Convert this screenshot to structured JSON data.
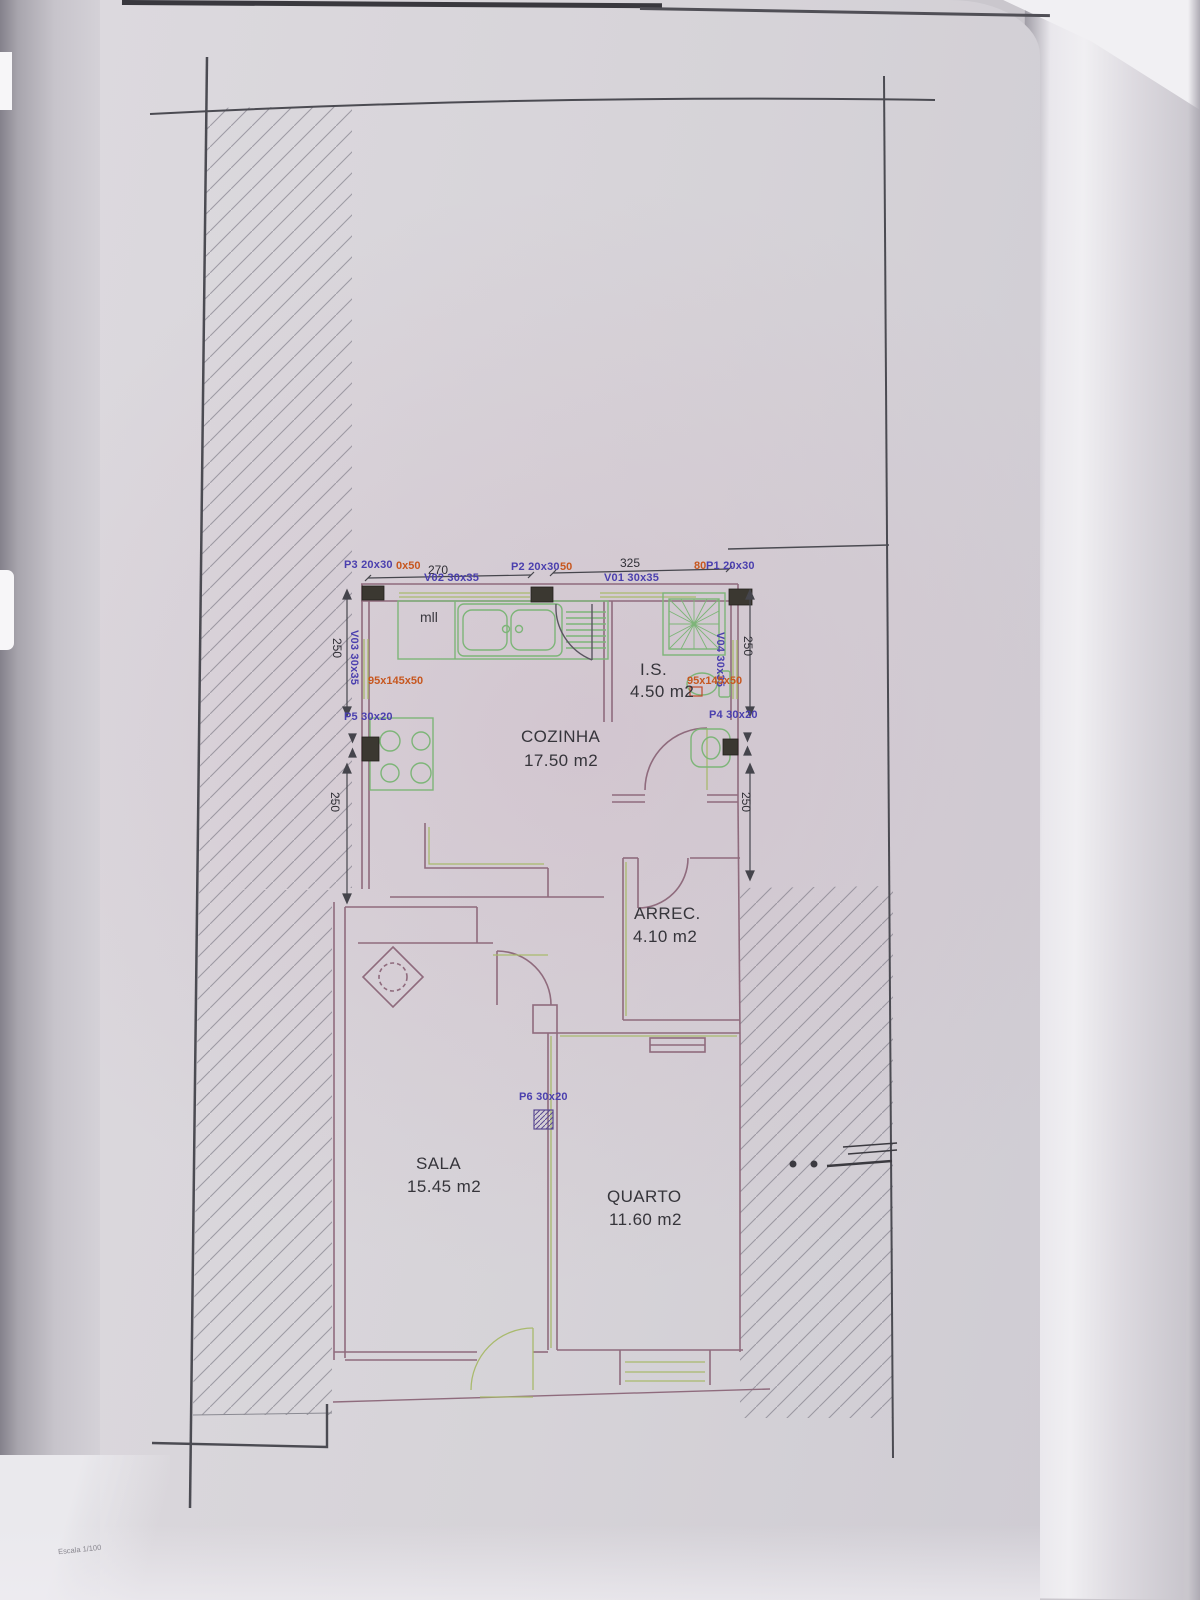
{
  "document": {
    "kind": "architectural floor plan (scanned photo)",
    "scale_note": "Escala 1/100"
  },
  "rooms": {
    "cozinha": {
      "name": "COZINHA",
      "area": "17.50 m2"
    },
    "is": {
      "name": "I.S.",
      "area": "4.50 m2"
    },
    "arrec": {
      "name": "ARREC.",
      "area": "4.10 m2"
    },
    "sala": {
      "name": "SALA",
      "area": "15.45 m2"
    },
    "quarto": {
      "name": "QUARTO",
      "area": "11.60 m2"
    }
  },
  "doors": {
    "p1": "P1 20x30",
    "p2": "P2 20x30",
    "p3": "P3 20x30",
    "p4": "P4 30x20",
    "p5": "P5 30x20",
    "p6": "P6 30x20"
  },
  "windows": {
    "v01": "V01 30x35",
    "v02": "V02 30x35",
    "v03": "V03 30x35",
    "v04": "V04 30x35"
  },
  "annotations": {
    "p3_extra": "0x50",
    "p2_extra": "50",
    "p1_extra": "80",
    "counter_left": "95x145x50",
    "counter_right": "95x145x50",
    "kitchen_note": "mll"
  },
  "dimensions": {
    "top_span_left": "270",
    "top_span_right": "325",
    "left_upper": "250",
    "left_lower": "250",
    "right_upper": "250",
    "right_lower": "250"
  },
  "colors": {
    "wall": "#8f6b7d",
    "fixture_green": "#7db578",
    "accent_olive": "#a9ba6d",
    "label_purple": "#4a3fae",
    "label_orange": "#c7571f",
    "ink_dark": "#4a4a52",
    "paper": "#d7d4d9"
  }
}
